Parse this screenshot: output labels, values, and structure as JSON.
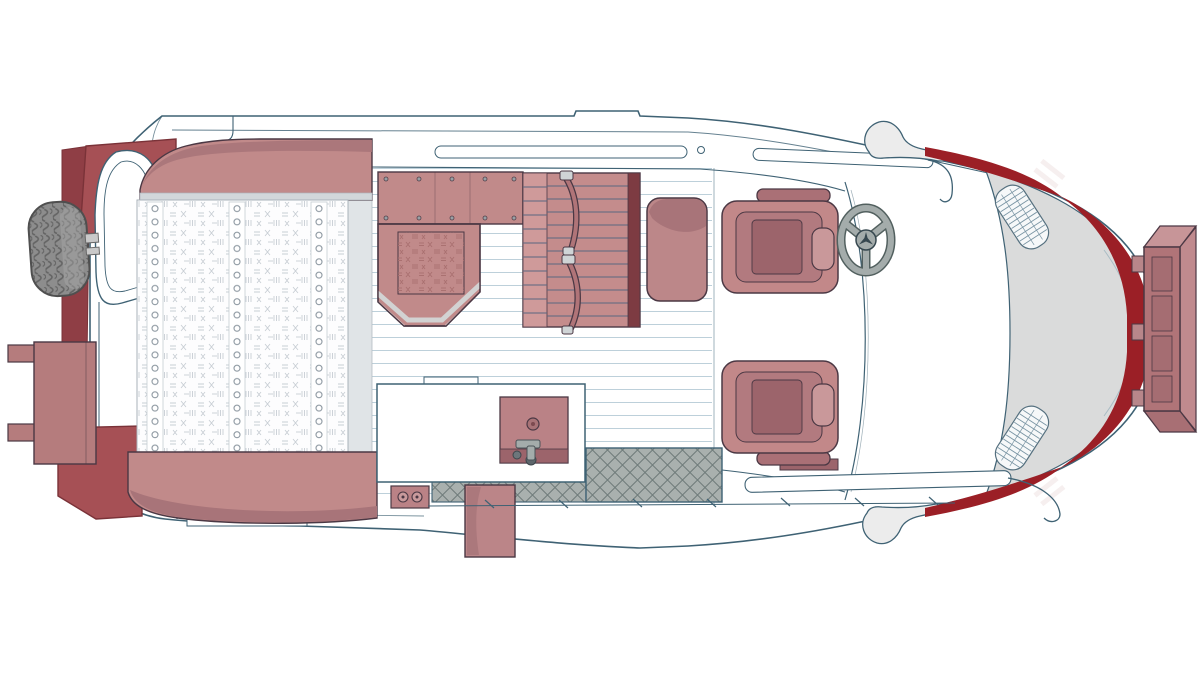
{
  "meta": {
    "description": "Top-down floor plan illustration of a camper van conversion",
    "view": "top-down, front of vehicle at right",
    "vehicle_logo": "mercedes-star"
  },
  "colors": {
    "line_blue": "#3f6274",
    "line_dark": "#4b3844",
    "mauve": "#c18a8a",
    "mauve_light": "#cf9a9a",
    "mauve_shade": "#a87479",
    "mauve_deep": "#9c646b",
    "maroon": "#7d3b42",
    "brick": "#a65055",
    "brick_deep": "#8f3e45",
    "accent_red": "#9b1f26",
    "body_gray": "#dadbdb",
    "step_gray": "#a9b0ae",
    "step_line": "#6f7b7a",
    "tire_gray": "#8d8d8d",
    "tread": "#646464",
    "rail_gray": "#e0e4e7",
    "floor_line": "#bdd0da",
    "stitch": "#c8ced4",
    "stitch_dark": "#a86e6e",
    "slat_line": "#5a6780",
    "metal": "#a4acab",
    "metal_dark": "#52605f",
    "white": "#ffffff"
  },
  "parts": {
    "van_body": {
      "label": "Van body shell, top view"
    },
    "rear_garage": {
      "label": "Rear storage boxes"
    },
    "spare_tire": {
      "label": "Spare tire on rear door"
    },
    "rear_door": {
      "label": "Open rear door"
    },
    "rear_shelf": {
      "label": "Open rear door shelf with hinges"
    },
    "bed": {
      "label": "Rear platform bed with button-tufted mattress"
    },
    "headboard": {
      "label": "Bed headboard cushion"
    },
    "footboard": {
      "label": "Bed footboard cushion"
    },
    "upper_counter": {
      "label": "Upper cabinet counter with rivets"
    },
    "dinette_seat": {
      "label": "Quilted dinette seat with trim"
    },
    "bench_seat": {
      "label": "Slatted bench seat with two seat belts"
    },
    "ottoman": {
      "label": "Ottoman cushion"
    },
    "galley_counter": {
      "label": "Galley counter"
    },
    "sink": {
      "label": "Sink with faucet and drain"
    },
    "entry_step": {
      "label": "Diamond-plate entry step at sliding door"
    },
    "step_panel": {
      "label": "Fold-out entry step panel"
    },
    "outlet": {
      "label": "Twin power outlet panel"
    },
    "driver_seat": {
      "label": "Driver captain seat"
    },
    "passenger_seat": {
      "label": "Passenger captain seat"
    },
    "steering_wheel": {
      "label": "Steering wheel with Mercedes star"
    },
    "mirror_left": {
      "label": "Left side mirror"
    },
    "mirror_right": {
      "label": "Right side mirror"
    },
    "hood": {
      "label": "Hood with air intake vents"
    },
    "front_accent": {
      "label": "Dark red front fascia accent with white stripes"
    },
    "front_box": {
      "label": "Front-mounted cargo box"
    }
  }
}
